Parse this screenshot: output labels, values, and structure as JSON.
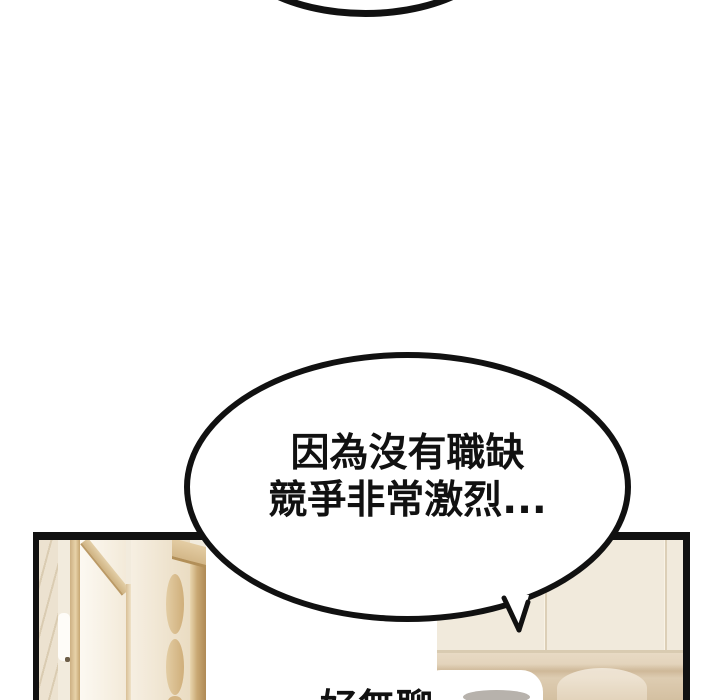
{
  "comic": {
    "bubbles": {
      "main": {
        "line1": "因為沒有職缺",
        "line2": "競爭非常激烈..."
      },
      "bottom_partial": {
        "text": "好無聊"
      }
    },
    "colors": {
      "ink": "#111111",
      "background": "#ffffff",
      "wall_cream": "#f2ebdd",
      "wood_tan": "#c9a873",
      "wall_lower_beige": "#d4c0a1",
      "shadow_gray": "#b7b2ac"
    }
  }
}
